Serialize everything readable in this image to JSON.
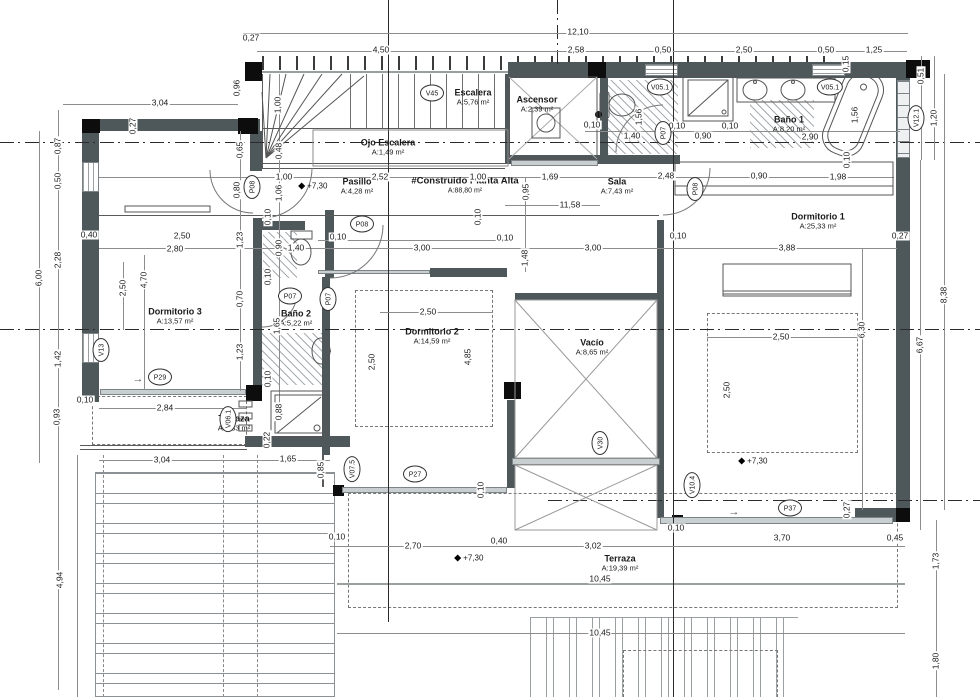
{
  "drawing": {
    "type": "floor-plan",
    "title": "#Construido Planta Alta",
    "title_area": "A:88,80 m²"
  },
  "rooms": [
    {
      "name": "Escalera",
      "area": "A:5,76 m²",
      "x": 473,
      "y": 97
    },
    {
      "name": "Ascensor",
      "area": "A:2,39 m²",
      "x": 537,
      "y": 104
    },
    {
      "name": "Baño 1",
      "area": "A:8,20 m²",
      "x": 789,
      "y": 124
    },
    {
      "name": "Ojo Escalera",
      "area": "A:1,49 m²",
      "x": 388,
      "y": 147
    },
    {
      "name": "Pasillo",
      "area": "A:4,28 m²",
      "x": 357,
      "y": 186
    },
    {
      "name": "#Construido Planta Alta",
      "area": "A:88,80 m²",
      "x": 465,
      "y": 186,
      "big": 1
    },
    {
      "name": "Sala",
      "area": "A:7,43 m²",
      "x": 617,
      "y": 186
    },
    {
      "name": "Dormitorio 1",
      "area": "A:25,33 m²",
      "x": 818,
      "y": 221
    },
    {
      "name": "Dormitorio 3",
      "area": "A:13,57 m²",
      "x": 175,
      "y": 316
    },
    {
      "name": "Baño 2",
      "area": "A:5,22 m²",
      "x": 296,
      "y": 318
    },
    {
      "name": "Dormitorio 2",
      "area": "A:14,59 m²",
      "x": 432,
      "y": 336
    },
    {
      "name": "Vacío",
      "area": "A:8,65 m²",
      "x": 592,
      "y": 347
    },
    {
      "name": "Terraza",
      "area": "A:2,83 m²",
      "x": 234,
      "y": 423
    },
    {
      "name": "Terraza",
      "area": "A:19,39 m²",
      "x": 620,
      "y": 563
    }
  ],
  "tags": [
    {
      "t": "V45",
      "x": 432,
      "y": 93
    },
    {
      "t": "V05.1",
      "x": 660,
      "y": 87
    },
    {
      "t": "V05.1",
      "x": 830,
      "y": 87
    },
    {
      "t": "V12.1",
      "x": 916,
      "y": 118,
      "r": 1
    },
    {
      "t": "P07",
      "x": 663,
      "y": 133,
      "r": 1
    },
    {
      "t": "P08",
      "x": 252,
      "y": 187,
      "r": 1
    },
    {
      "t": "P08",
      "x": 362,
      "y": 224
    },
    {
      "t": "P08",
      "x": 695,
      "y": 189,
      "r": 1
    },
    {
      "t": "P07",
      "x": 290,
      "y": 296
    },
    {
      "t": "P07",
      "x": 328,
      "y": 299,
      "r": 1
    },
    {
      "t": "V13",
      "x": 101,
      "y": 350,
      "r": 1
    },
    {
      "t": "P29",
      "x": 160,
      "y": 377
    },
    {
      "t": "V06.1",
      "x": 228,
      "y": 419,
      "r": 1
    },
    {
      "t": "V07.5",
      "x": 352,
      "y": 469,
      "r": 1
    },
    {
      "t": "P27",
      "x": 415,
      "y": 474
    },
    {
      "t": "V30",
      "x": 600,
      "y": 443,
      "r": 1
    },
    {
      "t": "V10.4",
      "x": 692,
      "y": 485,
      "r": 1
    },
    {
      "t": "P37",
      "x": 790,
      "y": 508
    }
  ],
  "levels": [
    {
      "t": "+7,30",
      "x": 302,
      "y": 186
    },
    {
      "t": "+7,30",
      "x": 458,
      "y": 558
    },
    {
      "t": "+7,30",
      "x": 742,
      "y": 461
    }
  ],
  "arrows": [
    {
      "t": "→",
      "x": 138,
      "y": 379
    },
    {
      "t": "→",
      "x": 734,
      "y": 512
    }
  ],
  "dimensions": [
    {
      "t": "0,27",
      "x": 251,
      "y": 38
    },
    {
      "t": "12,10",
      "x": 578,
      "y": 32
    },
    {
      "t": "4,50",
      "x": 381,
      "y": 50
    },
    {
      "t": "2,58",
      "x": 576,
      "y": 50
    },
    {
      "t": "0,50",
      "x": 663,
      "y": 50
    },
    {
      "t": "2,50",
      "x": 744,
      "y": 50
    },
    {
      "t": "0,50",
      "x": 826,
      "y": 50
    },
    {
      "t": "1,25",
      "x": 874,
      "y": 50
    },
    {
      "t": "3,04",
      "x": 160,
      "y": 103
    },
    {
      "t": "0,96",
      "x": 237,
      "y": 88,
      "r": 1
    },
    {
      "t": "0,27",
      "x": 133,
      "y": 126,
      "r": 1
    },
    {
      "t": "0,87",
      "x": 58,
      "y": 146,
      "r": 1
    },
    {
      "t": "1,00",
      "x": 278,
      "y": 105,
      "r": 1
    },
    {
      "t": "0,48",
      "x": 279,
      "y": 151,
      "r": 1
    },
    {
      "t": "0,65",
      "x": 240,
      "y": 150,
      "r": 1
    },
    {
      "t": "0,50",
      "x": 58,
      "y": 181,
      "r": 1
    },
    {
      "t": "0,80",
      "x": 237,
      "y": 190,
      "r": 1
    },
    {
      "t": "1,00",
      "x": 284,
      "y": 177
    },
    {
      "t": "1,06",
      "x": 279,
      "y": 193,
      "r": 1
    },
    {
      "t": "2,52",
      "x": 380,
      "y": 177
    },
    {
      "t": "1,00",
      "x": 478,
      "y": 177
    },
    {
      "t": "1,69",
      "x": 550,
      "y": 177
    },
    {
      "t": "2,48",
      "x": 666,
      "y": 176
    },
    {
      "t": "0,90",
      "x": 759,
      "y": 176
    },
    {
      "t": "1,98",
      "x": 838,
      "y": 177
    },
    {
      "t": "0,95",
      "x": 526,
      "y": 192,
      "r": 1
    },
    {
      "t": "11,58",
      "x": 570,
      "y": 205
    },
    {
      "t": "0,15",
      "x": 846,
      "y": 64,
      "r": 1
    },
    {
      "t": "0,51",
      "x": 921,
      "y": 76,
      "r": 1
    },
    {
      "t": "1,20",
      "x": 934,
      "y": 118,
      "r": 1
    },
    {
      "t": "1,56",
      "x": 639,
      "y": 117,
      "r": 1
    },
    {
      "t": "1,56",
      "x": 855,
      "y": 115,
      "r": 1
    },
    {
      "t": "0,10",
      "x": 592,
      "y": 125
    },
    {
      "t": "1,40",
      "x": 632,
      "y": 136
    },
    {
      "t": "0,10",
      "x": 677,
      "y": 126
    },
    {
      "t": "0,90",
      "x": 703,
      "y": 136
    },
    {
      "t": "0,10",
      "x": 730,
      "y": 126
    },
    {
      "t": "2,90",
      "x": 810,
      "y": 137
    },
    {
      "t": "0,10",
      "x": 847,
      "y": 160,
      "r": 1
    },
    {
      "t": "0,40",
      "x": 89,
      "y": 235
    },
    {
      "t": "2,50",
      "x": 182,
      "y": 236
    },
    {
      "t": "2,80",
      "x": 175,
      "y": 249
    },
    {
      "t": "2,28",
      "x": 58,
      "y": 260,
      "r": 1
    },
    {
      "t": "6,00",
      "x": 39,
      "y": 278,
      "r": 1
    },
    {
      "t": "4,70",
      "x": 144,
      "y": 280,
      "r": 1
    },
    {
      "t": "2,50",
      "x": 123,
      "y": 288,
      "r": 1
    },
    {
      "t": "1,23",
      "x": 240,
      "y": 240,
      "r": 1
    },
    {
      "t": "0,10",
      "x": 268,
      "y": 217,
      "r": 1
    },
    {
      "t": "0,90",
      "x": 279,
      "y": 248,
      "r": 1
    },
    {
      "t": "0,10",
      "x": 268,
      "y": 277,
      "r": 1
    },
    {
      "t": "1,40",
      "x": 296,
      "y": 248
    },
    {
      "t": "0,10",
      "x": 338,
      "y": 237
    },
    {
      "t": "3,00",
      "x": 422,
      "y": 248
    },
    {
      "t": "0,10",
      "x": 478,
      "y": 217,
      "r": 1
    },
    {
      "t": "0,10",
      "x": 505,
      "y": 238
    },
    {
      "t": "1,48",
      "x": 525,
      "y": 258,
      "r": 1
    },
    {
      "t": "3,00",
      "x": 593,
      "y": 248
    },
    {
      "t": "0,10",
      "x": 678,
      "y": 236
    },
    {
      "t": "3,88",
      "x": 787,
      "y": 248
    },
    {
      "t": "0,27",
      "x": 900,
      "y": 236
    },
    {
      "t": "0,70",
      "x": 240,
      "y": 299,
      "r": 1
    },
    {
      "t": "1,23",
      "x": 240,
      "y": 352,
      "r": 1
    },
    {
      "t": "1,65",
      "x": 277,
      "y": 326,
      "r": 1
    },
    {
      "t": "0,10",
      "x": 268,
      "y": 379,
      "r": 1
    },
    {
      "t": "2,50",
      "x": 428,
      "y": 312
    },
    {
      "t": "2,50",
      "x": 372,
      "y": 362,
      "r": 1
    },
    {
      "t": "4,85",
      "x": 468,
      "y": 357,
      "r": 1
    },
    {
      "t": "1,42",
      "x": 58,
      "y": 359,
      "r": 1
    },
    {
      "t": "0,93",
      "x": 57,
      "y": 417,
      "r": 1
    },
    {
      "t": "0,10",
      "x": 85,
      "y": 400
    },
    {
      "t": "2,84",
      "x": 165,
      "y": 408
    },
    {
      "t": "0,88",
      "x": 279,
      "y": 412,
      "r": 1
    },
    {
      "t": "0,22",
      "x": 267,
      "y": 440,
      "r": 1
    },
    {
      "t": "2,50",
      "x": 781,
      "y": 337
    },
    {
      "t": "2,50",
      "x": 727,
      "y": 390,
      "r": 1
    },
    {
      "t": "6,30",
      "x": 862,
      "y": 330,
      "r": 1
    },
    {
      "t": "6,67",
      "x": 920,
      "y": 345,
      "r": 1
    },
    {
      "t": "8,38",
      "x": 944,
      "y": 295,
      "r": 1
    },
    {
      "t": "3,04",
      "x": 162,
      "y": 460
    },
    {
      "t": "1,65",
      "x": 288,
      "y": 459
    },
    {
      "t": "0,85",
      "x": 321,
      "y": 470,
      "r": 1
    },
    {
      "t": "0,10",
      "x": 481,
      "y": 490,
      "r": 1
    },
    {
      "t": "0,10",
      "x": 337,
      "y": 537
    },
    {
      "t": "2,70",
      "x": 413,
      "y": 546
    },
    {
      "t": "0,40",
      "x": 499,
      "y": 541
    },
    {
      "t": "3,02",
      "x": 593,
      "y": 546
    },
    {
      "t": "0,10",
      "x": 676,
      "y": 528
    },
    {
      "t": "3,70",
      "x": 782,
      "y": 538
    },
    {
      "t": "0,45",
      "x": 895,
      "y": 538
    },
    {
      "t": "0,27",
      "x": 847,
      "y": 510,
      "r": 1
    },
    {
      "t": "10,45",
      "x": 600,
      "y": 579
    },
    {
      "t": "10,45",
      "x": 600,
      "y": 633
    },
    {
      "t": "4,94",
      "x": 60,
      "y": 580,
      "r": 1
    },
    {
      "t": "1,73",
      "x": 936,
      "y": 561,
      "r": 1
    },
    {
      "t": "1,80",
      "x": 936,
      "y": 661,
      "r": 1
    }
  ]
}
